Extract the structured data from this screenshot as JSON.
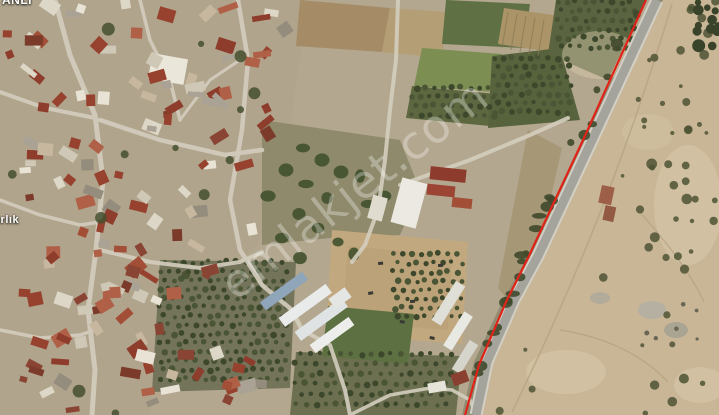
{
  "watermark": {
    "text": "emlakjet.com",
    "color": "#ffffff",
    "opacity": 0.3
  },
  "labels": {
    "top_left_partial": "ANLI",
    "left_partial": "ırlık"
  },
  "boundary": {
    "color": "#e02318"
  },
  "palette": {
    "sand": "#c9b697",
    "road": "#a5a49c",
    "town_ground": "#b0a48c",
    "roof_red": "#8e3c2c",
    "building_white": "#e8e3d5",
    "orchard_dark_green": "#4a5535",
    "field_green": "#7d8e53",
    "greenhouse_white": "#e9ebea",
    "dirt_lot": "#c2a87e"
  }
}
